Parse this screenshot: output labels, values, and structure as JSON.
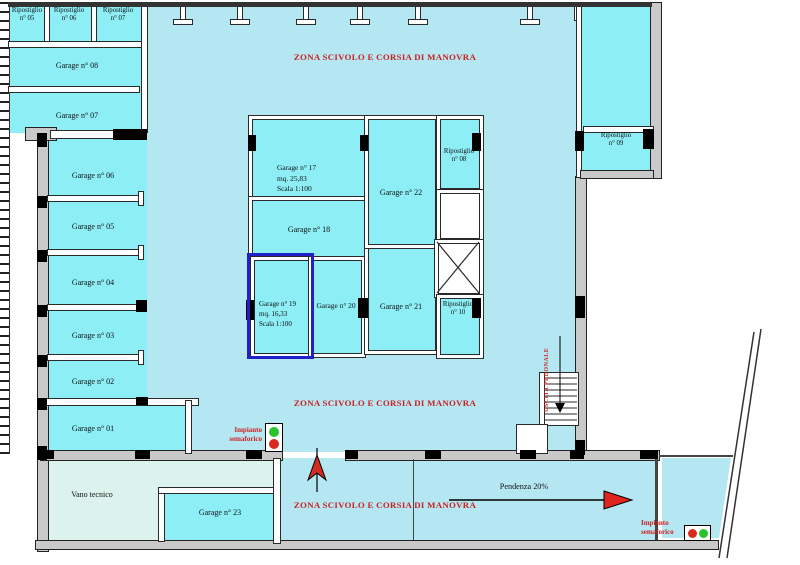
{
  "colors": {
    "room_fill": "#8deef6",
    "circulation_fill": "#b5e7f3",
    "vano_fill": "#dcf2ec",
    "wall_gray": "#c9c9c9",
    "annotation_red": "#cc1f1f",
    "highlight_blue": "#2121c8",
    "signal_green": "#27c32d",
    "signal_red": "#d92a20"
  },
  "plan": {
    "zona_label": "ZONA SCIVOLO E CORSIA DI MANOVRA",
    "pendenza_label": "Pendenza 20%",
    "uscita_label": "USCITA PEDONALE",
    "vano_label": "Vano tecnico",
    "impianto": {
      "line1": "Impianto",
      "line2": "semaforico"
    },
    "storage": {
      "r05": {
        "line1": "Ripostiglio",
        "line2": "n° 05"
      },
      "r06": {
        "line1": "Ripostiglio",
        "line2": "n° 06"
      },
      "r07": {
        "line1": "Ripostiglio",
        "line2": "n° 07"
      },
      "r08": {
        "line1": "Ripostiglio",
        "line2": "n° 08"
      },
      "r09": {
        "line1": "Ripostiglio",
        "line2": "n° 09"
      },
      "r10": {
        "line1": "Ripostiglio",
        "line2": "n° 10"
      }
    },
    "garages": {
      "g01": "Garage n° 01",
      "g02": "Garage n° 02",
      "g03": "Garage n° 03",
      "g04": "Garage n° 04",
      "g05": "Garage n° 05",
      "g06": "Garage n° 06",
      "g07": "Garage n° 07",
      "g08": "Garage n° 08",
      "g17": {
        "name": "Garage n° 17",
        "area": "mq. 25,83",
        "scale": "Scala 1:100"
      },
      "g18": "Garage n° 18",
      "g19": {
        "name": "Garage n° 19",
        "area": "mq. 16,33",
        "scale": "Scala 1:100"
      },
      "g20": "Garage n° 20",
      "g21": "Garage n° 21",
      "g22": "Garage n° 22",
      "g23": "Garage n° 23"
    }
  }
}
